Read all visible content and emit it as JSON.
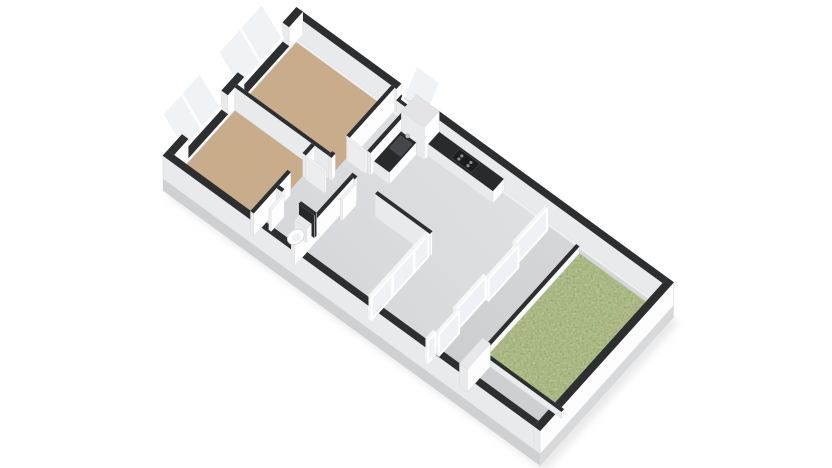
{
  "page": {
    "background": "#ffffff",
    "width": 832,
    "height": 468
  },
  "rooms": [
    {
      "id": "bedroom-2",
      "floor": "wood"
    },
    {
      "id": "bedroom-1",
      "floor": "wood"
    },
    {
      "id": "bedroom-3",
      "floor": "wood"
    },
    {
      "id": "hallway",
      "floor": "gray"
    },
    {
      "id": "pantry-corridor",
      "floor": "gray"
    },
    {
      "id": "wc",
      "floor": "gray"
    },
    {
      "id": "kitchen-living-room",
      "floor": "gray"
    },
    {
      "id": "terrace",
      "floor": "gray"
    },
    {
      "id": "garden",
      "floor": "grass"
    }
  ],
  "scene": {
    "projection": {
      "ox": 298,
      "oy": 40,
      "ux": 24,
      "uy": 17.5,
      "vx": -18,
      "vy": 20,
      "hz": 23,
      "slab": 12
    },
    "colors": {
      "wallTop": "#2d2e30",
      "wallTopStroke": "#232426",
      "faceBack": "#f7f7f8",
      "facePx": "#fdfdfe",
      "facePy": "#e9eaec",
      "faceStroke": "#dcdddf",
      "darkFace": "#2f3032",
      "wood": "#cbab89",
      "gray1": "#e2e3e5",
      "gray2": "#d2d3d6",
      "terrace1": "#d9dadc",
      "terrace2": "#c9cacc",
      "grass": "#7f9154",
      "counterTop": "#292a2c",
      "glass": "#eef2f5",
      "glassTop": "#f5f6f7",
      "doorTop": "#f2f2f4",
      "whiteTop": "#e8e8ea",
      "cabinetTop": "#e4e4e6",
      "slabSW": "#cfd0d2",
      "slabSE": "#d8d9db",
      "slabN": "#efeff0",
      "shadow": "#dadada"
    },
    "outline": [
      -0.26,
      -0.26,
      15.72,
      7.42
    ],
    "floors": [
      {
        "id": "bedroom-2-floor",
        "r": [
          0,
          0,
          3.9,
          3.38
        ],
        "fill": "wood"
      },
      {
        "id": "bedroom-1-floor",
        "r": [
          0,
          3.51,
          3.2,
          3.39
        ],
        "fill": "wood"
      },
      {
        "id": "bedroom-3-floor",
        "r": [
          5.03,
          3.64,
          3.07,
          3.26
        ],
        "fill": "wood"
      },
      {
        "id": "pantry-floor",
        "r": [
          3.9,
          0,
          1.0,
          3.51
        ],
        "fill": "gray"
      },
      {
        "id": "hallway-floor",
        "r": [
          3.2,
          3.51,
          1.7,
          3.39
        ],
        "fill": "gray"
      },
      {
        "id": "living-floor",
        "r": [
          4.9,
          0,
          5.7,
          6.9
        ],
        "fill": "gray"
      },
      {
        "id": "terrace-floor",
        "r": [
          10.6,
          0,
          4.6,
          6.9
        ],
        "fill": "terrace"
      },
      {
        "id": "garden-grass",
        "r": [
          11.91,
          0.25,
          3.04,
          5.25
        ],
        "fill": "grass"
      }
    ],
    "walls": [
      {
        "id": "wall-ne-a",
        "r": [
          -0.26,
          -0.26,
          4.36,
          0.26
        ]
      },
      {
        "id": "wall-ne-sill",
        "r": [
          4.1,
          -0.26,
          1.1,
          0.26
        ],
        "zh": 0.5
      },
      {
        "id": "wall-ne-b",
        "r": [
          5.2,
          -0.26,
          10.26,
          0.26
        ]
      },
      {
        "id": "wall-nw-a",
        "r": [
          -0.26,
          -0.26,
          0.26,
          0.76
        ]
      },
      {
        "id": "wall-nw-b",
        "r": [
          -0.26,
          3.0,
          0.26,
          0.9
        ]
      },
      {
        "id": "wall-nw-c",
        "r": [
          -0.26,
          6.1,
          0.26,
          1.06
        ]
      },
      {
        "id": "wall-nw-sill-1",
        "r": [
          -0.26,
          0.5,
          0.26,
          2.5
        ],
        "zh": 0.16
      },
      {
        "id": "wall-nw-sill-2",
        "r": [
          -0.26,
          3.9,
          0.26,
          2.2
        ],
        "zh": 0.16
      },
      {
        "id": "wall-se",
        "r": [
          15.2,
          -0.26,
          0.26,
          7.42
        ]
      },
      {
        "id": "wall-sw",
        "r": [
          -0.26,
          6.9,
          15.72,
          0.26
        ]
      },
      {
        "id": "wall-bed-divider",
        "r": [
          0,
          3.38,
          3.9,
          0.13
        ]
      },
      {
        "id": "wall-bed2-se-a",
        "r": [
          3.9,
          0,
          0.13,
          2.5
        ]
      },
      {
        "id": "wall-bed2-se-b",
        "r": [
          3.9,
          3.3,
          0.13,
          0.21
        ]
      },
      {
        "id": "wall-pantry-se",
        "r": [
          4.77,
          0,
          0.13,
          2.5
        ]
      },
      {
        "id": "wall-bed1-se-a",
        "r": [
          3.2,
          3.51,
          0.13,
          0.49
        ]
      },
      {
        "id": "wall-bed1-se-b",
        "r": [
          3.2,
          4.85,
          0.13,
          2.05
        ]
      },
      {
        "id": "wall-hall-stub",
        "r": [
          4.9,
          3.51,
          0.2,
          0.13
        ]
      },
      {
        "id": "wall-hall-living",
        "r": [
          5.95,
          3.51,
          2.28,
          0.13
        ]
      },
      {
        "id": "wall-bed3-ne",
        "r": [
          4.9,
          3.64,
          0.13,
          3.26
        ]
      },
      {
        "id": "wall-wc-a",
        "r": [
          3.33,
          5.5,
          0.22,
          0.13
        ]
      },
      {
        "id": "wall-wc-dark",
        "r": [
          4.25,
          5.5,
          0.65,
          0.13
        ],
        "style": "dark"
      },
      {
        "id": "wall-walkway-stub",
        "r": [
          11.91,
          5.63,
          0.32,
          1.27
        ],
        "style": "white"
      },
      {
        "id": "garden-edge-nw",
        "r": [
          11.78,
          0.25,
          0.13,
          5.37
        ],
        "zh": 0.3
      },
      {
        "id": "garden-edge-sw",
        "r": [
          11.78,
          5.5,
          3.42,
          0.13
        ],
        "zh": 0.3
      }
    ],
    "glass_walls": [
      {
        "id": "slider-panel-1",
        "r": [
          10.5,
          0.3,
          0.1,
          1.75
        ]
      },
      {
        "id": "slider-panel-2",
        "r": [
          10.62,
          2.05,
          0.1,
          1.65
        ]
      },
      {
        "id": "slider-panel-3",
        "r": [
          10.5,
          3.7,
          0.1,
          1.65
        ]
      },
      {
        "id": "slider-panel-4",
        "r": [
          10.62,
          5.35,
          0.1,
          1.1
        ]
      },
      {
        "id": "terrace-door",
        "r": [
          10.5,
          6.5,
          0.1,
          0.4
        ]
      },
      {
        "id": "bed3-partition-door",
        "r": [
          8.1,
          3.7,
          0.11,
          0.78
        ]
      },
      {
        "id": "bed3-partition-a",
        "r": [
          8.1,
          4.52,
          0.11,
          1.15
        ]
      },
      {
        "id": "bed3-partition-b",
        "r": [
          8.1,
          5.71,
          0.11,
          1.15
        ]
      }
    ],
    "windows_tilted": [
      {
        "id": "bedroom-2-window",
        "side": "nw",
        "a": 0.5,
        "b": 2.95,
        "panes": 2
      },
      {
        "id": "bedroom-1-window",
        "side": "nw",
        "a": 3.95,
        "b": 6.05,
        "panes": 2
      },
      {
        "id": "kitchen-window",
        "side": "ne",
        "a": 4.15,
        "b": 5.15,
        "panes": 1
      }
    ],
    "doors": [
      {
        "id": "bedroom-1-door-leaf",
        "r": [
          3.35,
          3.95,
          0.78,
          0.09
        ]
      },
      {
        "id": "bedroom-3-door-leaf",
        "r": [
          5.12,
          3.7,
          0.09,
          0.78
        ]
      },
      {
        "id": "bedroom-2-door-leaf",
        "r": [
          3.97,
          2.47,
          0.75,
          0.09
        ]
      },
      {
        "id": "wc-door-leaf",
        "r": [
          3.57,
          5.65,
          0.09,
          0.72
        ]
      }
    ],
    "furniture": [
      {
        "id": "kitchen-tall-cabinet",
        "kind": "box",
        "r": [
          4.95,
          0.03,
          0.95,
          0.82
        ],
        "zh": 1.42,
        "top": "cabinetTop"
      },
      {
        "id": "kitchen-counter-arm",
        "kind": "box",
        "r": [
          4.93,
          0.85,
          0.64,
          1.5
        ],
        "zh": 0.52,
        "top": "counterTop"
      },
      {
        "id": "kitchen-counter-wall",
        "kind": "box",
        "r": [
          5.9,
          0.02,
          2.7,
          0.62
        ],
        "zh": 0.52,
        "top": "counterTop"
      },
      {
        "id": "kitchen-cooktop",
        "kind": "flat",
        "r": [
          6.8,
          0.1,
          0.85,
          0.45
        ],
        "z": 0.53,
        "fill": "#1c1d1f"
      },
      {
        "id": "kitchen-sink",
        "kind": "flat",
        "r": [
          5.02,
          1.0,
          0.48,
          0.62
        ],
        "z": 0.53,
        "fill": "#45474a"
      },
      {
        "id": "toilet-tank",
        "kind": "box",
        "r": [
          4.3,
          5.66,
          0.5,
          0.26
        ],
        "zh": 0.58,
        "top": "whiteTop"
      },
      {
        "id": "toilet-bowl",
        "kind": "bowl",
        "c": [
          4.56,
          6.2
        ],
        "rx": 9,
        "ry": 6.8,
        "rot": -36
      }
    ]
  }
}
